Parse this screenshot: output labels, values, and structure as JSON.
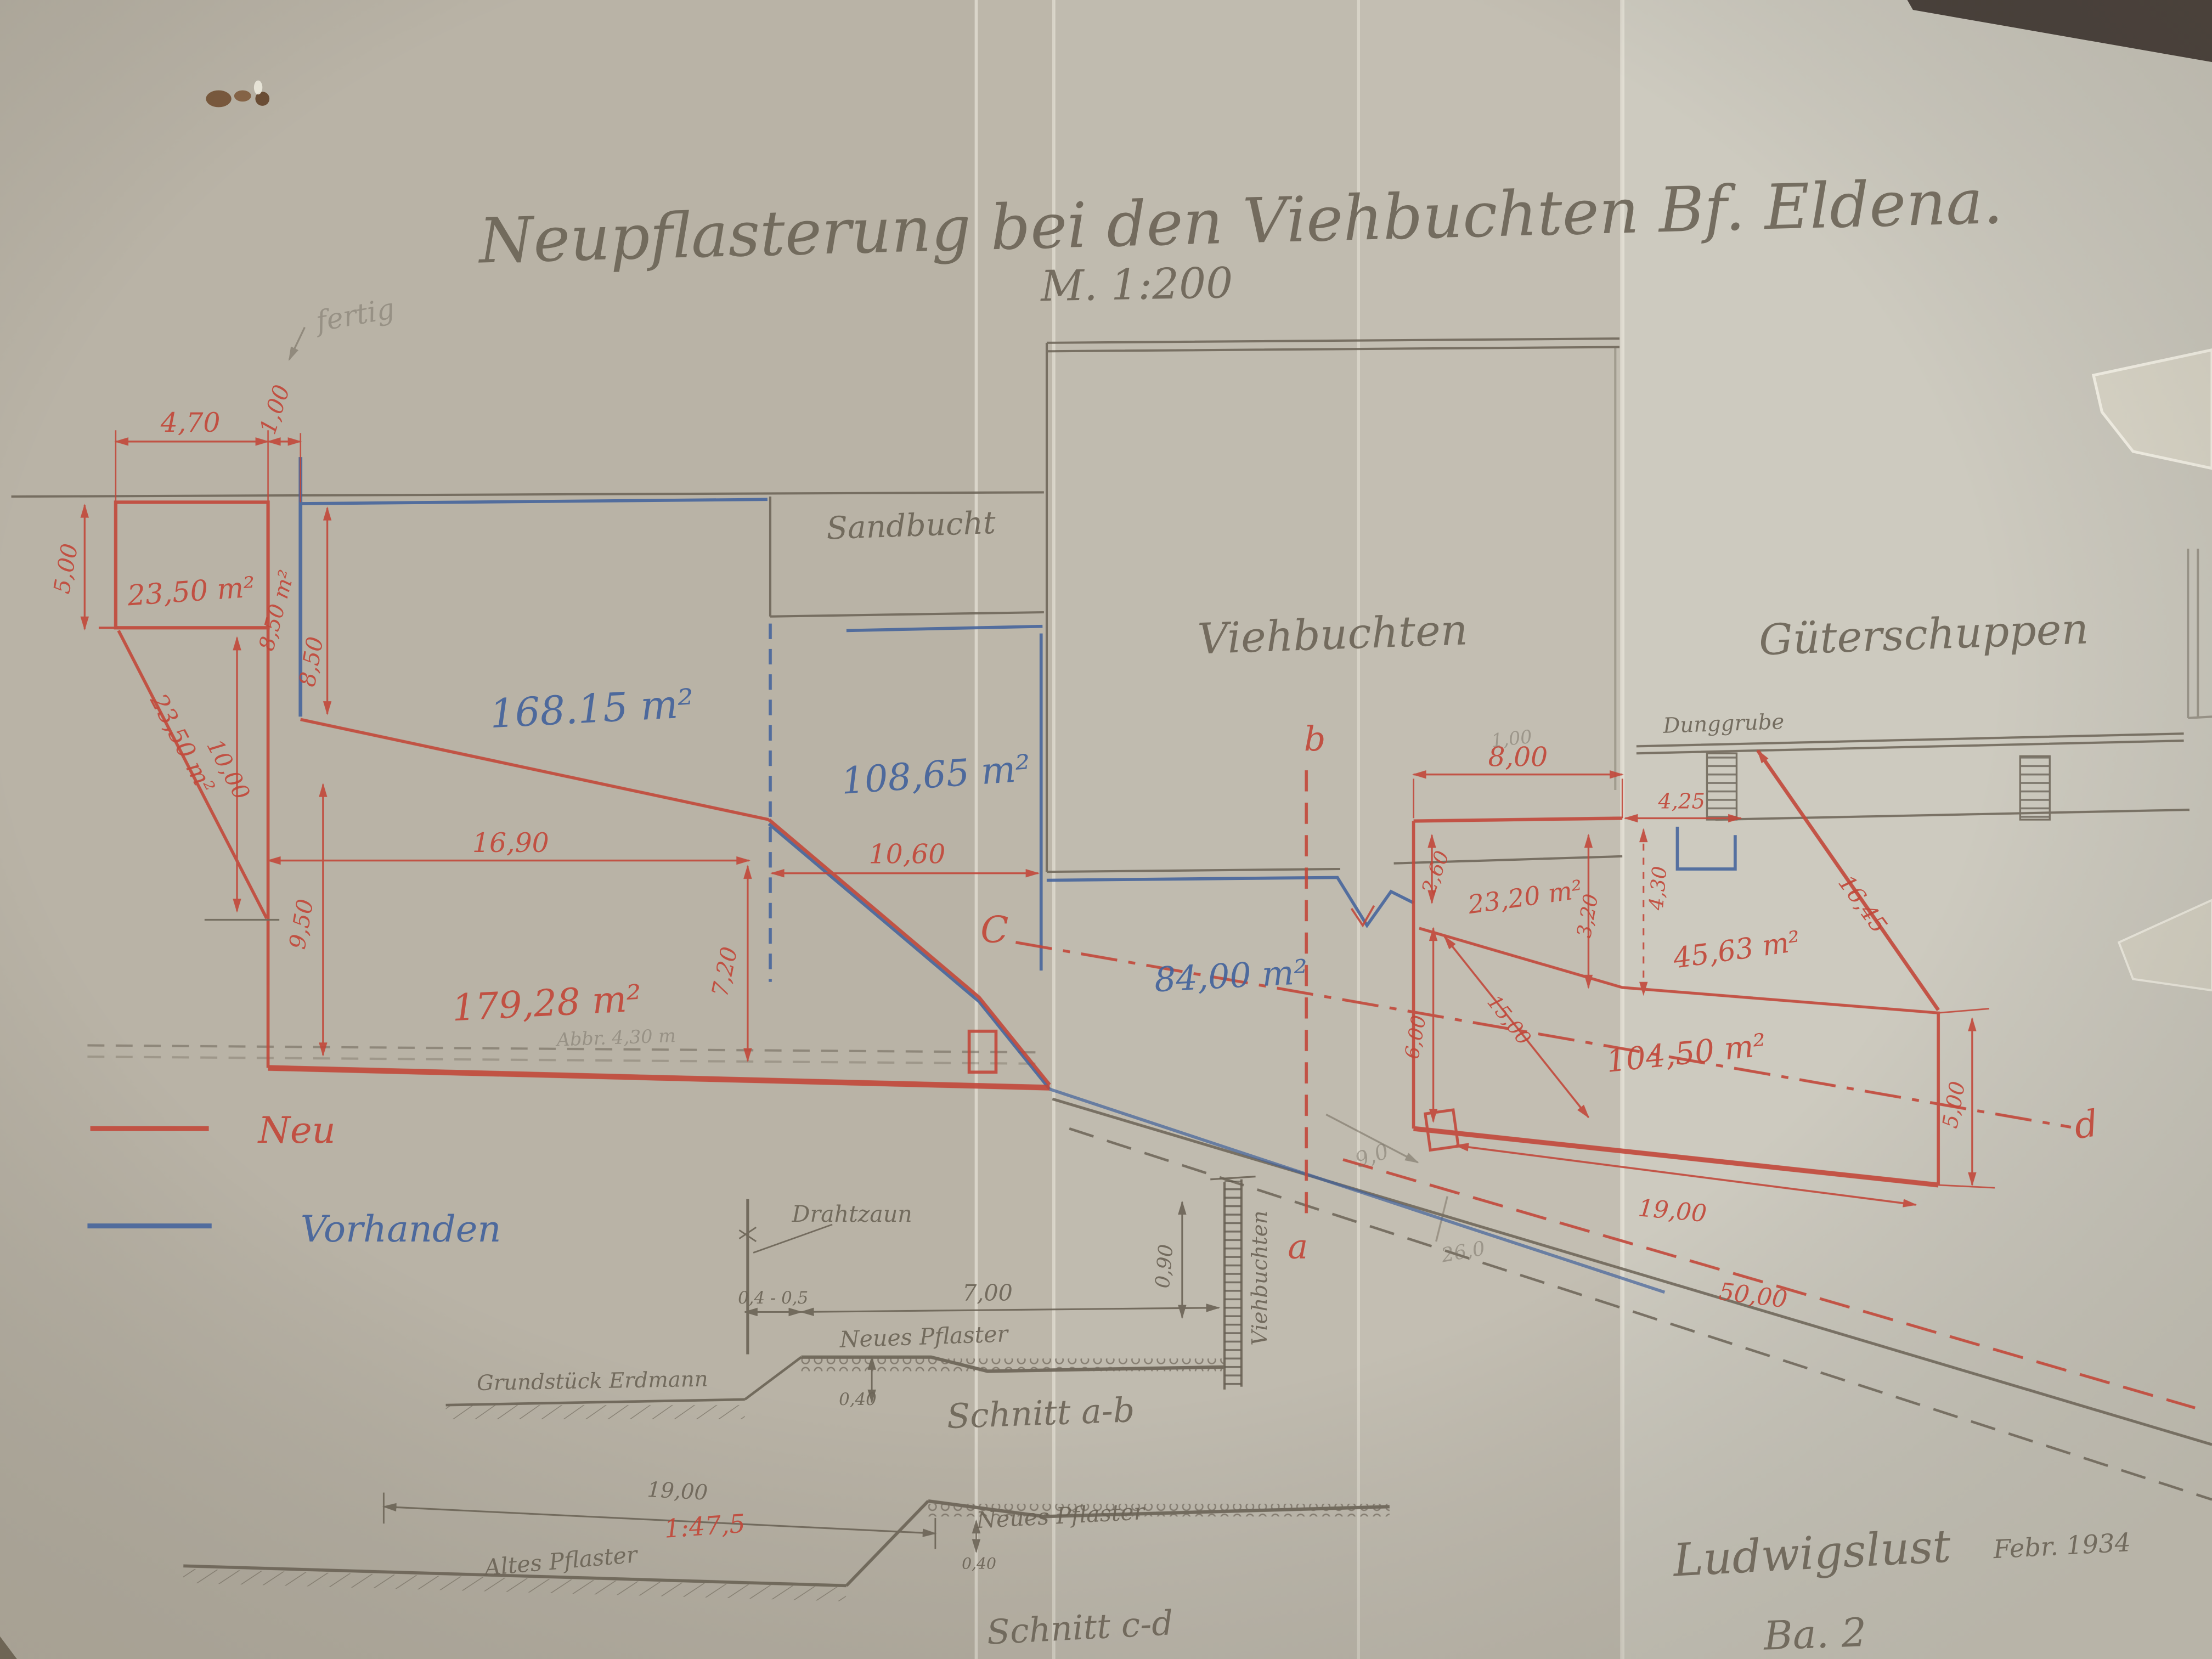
{
  "document": {
    "title": "Neupflasterung bei den Viehbuchten Bf. Eldena.",
    "scale": "M. 1:200",
    "footer": {
      "place": "Ludwigslust",
      "date": "Febr. 1934",
      "sheet": "Ba. 2"
    },
    "colors": {
      "paper": "#c0bbaf",
      "pencil": "#6b6356",
      "new_red": "#c2483a",
      "existing_blue": "#44639c"
    }
  },
  "legend": {
    "neu": "Neu",
    "vorhanden": "Vorhanden"
  },
  "plan": {
    "buildings": {
      "sandbucht": "Sandbucht",
      "viehbuchten": "Viehbuchten",
      "gueterschuppen": "Güterschuppen",
      "dunggrube": "Dunggrube"
    },
    "areas": {
      "rect_tl": "23,50 m²",
      "strip_850": "8,50 m²",
      "diag_2350": "23,50 m²",
      "blue_16815": "168.15 m²",
      "blue_10865": "108,65 m²",
      "red_17928": "179,28 m²",
      "blue_8400": "84,00 m²",
      "red_2320": "23,20 m²",
      "red_4563": "45,63 m²",
      "red_10450": "104,50 m²"
    },
    "dimensions": {
      "d470": "4,70",
      "d100": "1,00",
      "d500": "5,00",
      "d850": "8,50",
      "d1000": "10,00",
      "d950": "9,50",
      "d1690": "16,90",
      "d720": "7,20",
      "d1060": "10,60",
      "d800": "8,00",
      "d260": "2,60",
      "d320": "3,20",
      "d425": "4,25",
      "d430": "4,30",
      "d600": "6,00",
      "d1500": "15,00",
      "d1645": "16,45",
      "d500r": "5,00",
      "d1900": "19,00",
      "d5000": "50,00"
    },
    "section_markers": {
      "a": "a",
      "b": "b",
      "c": "C",
      "d": "d"
    },
    "pencil_notes": {
      "fertig": "fertig",
      "abbr": "Abbr. 4,30 m",
      "n100": "1,00",
      "n90": "9,0",
      "n260": "26,0"
    }
  },
  "section_ab": {
    "title": "Schnitt a-b",
    "drahtzaun": "Drahtzaun",
    "neues_pflaster": "Neues Pflaster",
    "grundstueck": "Grundstück Erdmann",
    "wall_label": "Viehbuchten",
    "d_fence": "0,4 - 0,5",
    "d_700": "7,00",
    "d_040": "0,40",
    "d_090": "0,90"
  },
  "section_cd": {
    "title": "Schnitt c-d",
    "altes_pflaster": "Altes Pflaster",
    "neues_pflaster": "Neues Pflaster",
    "gradient": "1:47,5",
    "d_1900": "19,00",
    "d_040": "0,40"
  }
}
